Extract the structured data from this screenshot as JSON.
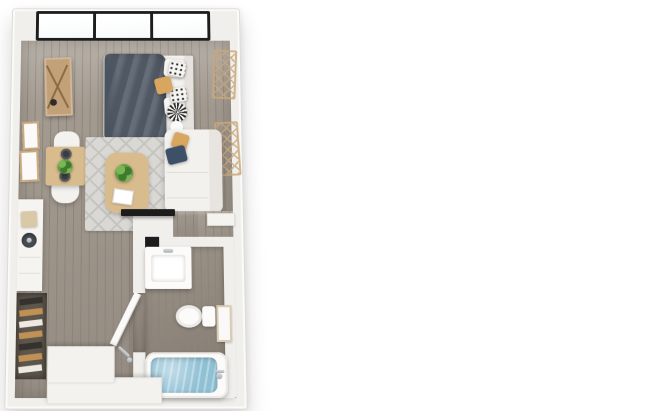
{
  "scene": {
    "label": "3D top-down floor plan of a studio apartment",
    "view": "top-down 3D render",
    "background": "#ffffff"
  },
  "colors": {
    "page_bg": "#ffffff",
    "wall": "#f1efec",
    "wall_edge": "#dfdcd7",
    "floor": "#a2998e",
    "floor_line": "#8d8479",
    "floor_bath": "#968d82",
    "window_frame": "#1d1d1d",
    "glass": "#f7f9fa",
    "linen": "#f3f2ef",
    "headboard": "#e6e3de",
    "duvet": "#59636e",
    "duvet_fold": "#49535d",
    "pillow_white": "#f6f5f3",
    "pillow_mustard": "#d8a65f",
    "pillow_navy": "#3e5068",
    "pattern_dark": "#2d2d2d",
    "sofa": "#f3f1ee",
    "sofa_back": "#e8e5e0",
    "rug": "#dad8d4",
    "rug_pattern": "#c6c4bf",
    "wood": "#c2a179",
    "wood_light": "#d8bc8e",
    "wood_dark": "#8a6b42",
    "frame_tan": "#c9a87c",
    "plant_green": "#5f9c43",
    "plant_dark": "#3f7a2e",
    "plate": "#3a3d40",
    "water": "#8fc0d4",
    "tv_black": "#1c1c1c",
    "chrome": "#a7adb2",
    "porcelain": "#fcfbfa",
    "counter": "#f5f4f1",
    "board": "#d9c9a6",
    "sink_dark": "#474c52",
    "closet_recess": "#5d564c",
    "clothes_gold": "#c09154",
    "clothes_cream": "#eee9e1",
    "clothes_dark": "#35322e",
    "platform": "#f3f2ef"
  },
  "rooms": {
    "living_bedroom": {
      "label": "living and sleeping area",
      "items": [
        "glass-wall-window",
        "ladder-shelf",
        "wall-art-frames",
        "dining-table",
        "dining-chairs",
        "dinner-plates",
        "centerpiece-plant",
        "bed",
        "duvet",
        "pillows",
        "round-cushion",
        "rug",
        "coffee-table",
        "potted-plant",
        "book",
        "sofa",
        "lattice-wall-decor",
        "wall-tv"
      ]
    },
    "kitchenette": {
      "label": "kitchenette counter",
      "items": [
        "counter",
        "cutting-board",
        "sink-burner"
      ]
    },
    "closet": {
      "label": "open closet with hanging clothes",
      "items": [
        "hanging-clothes"
      ]
    },
    "bathroom": {
      "label": "bathroom",
      "items": [
        "vanity-sink",
        "toilet",
        "wall-frame-mirror",
        "bathtub",
        "tub-faucet",
        "open-door"
      ]
    },
    "entry": {
      "label": "entry steps",
      "items": [
        "upper-step",
        "lower-step",
        "door-handle"
      ]
    }
  }
}
